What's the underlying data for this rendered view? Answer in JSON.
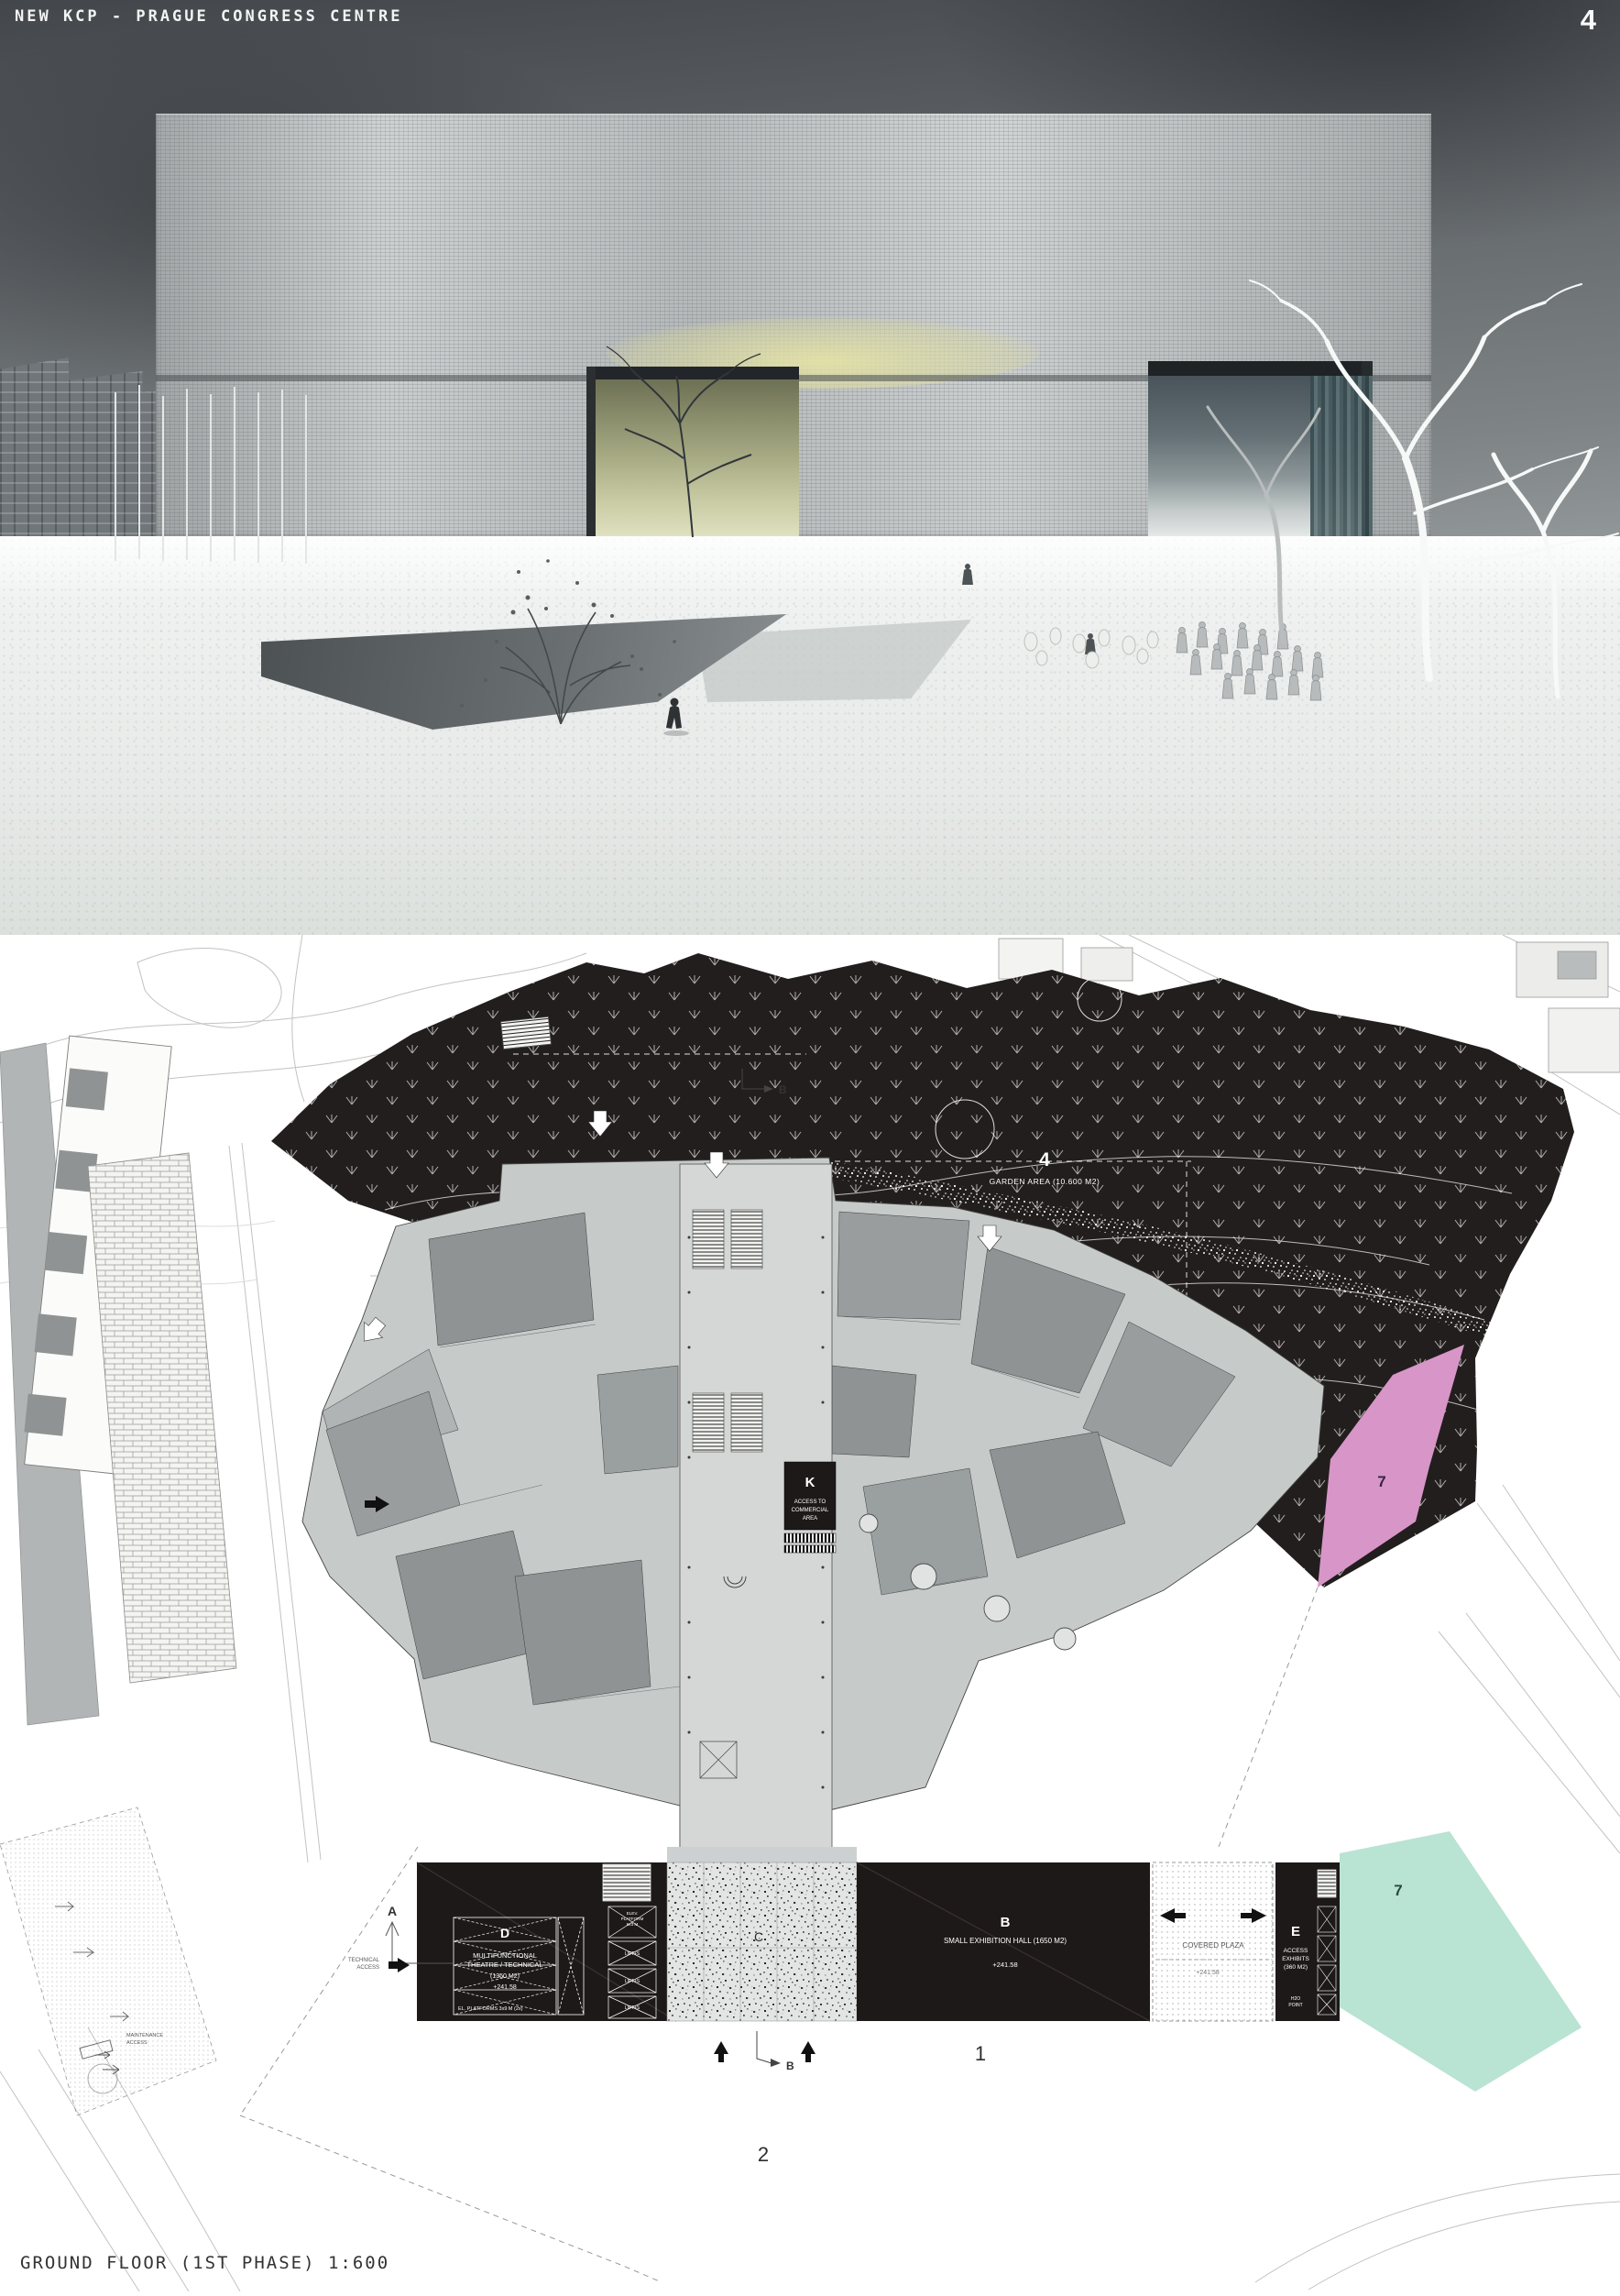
{
  "header": {
    "title": "NEW KCP - PRAGUE CONGRESS CENTRE",
    "page_number": "4"
  },
  "footer": {
    "caption": "GROUND FLOOR (1ST PHASE) 1:600"
  },
  "plan": {
    "garden_number": "4",
    "garden_label": "GARDEN AREA (10.600 M2)",
    "k_letter": "K",
    "k_line1": "ACCESS TO",
    "k_line2": "COMMERCIAL",
    "k_line3": "AREA",
    "d_letter": "D",
    "d_line1": "MULTIFUNCTIONAL",
    "d_line2": "THEATRE / TECHNICAL",
    "d_line3": "(1350 M2)",
    "d_level": "+241.58",
    "d_note": "EL. PLATFORMS 3x9 M (2x)",
    "elev_line1": "ELEV.",
    "elev_line2": "PLATFORM",
    "elev_line3": "6x3 M",
    "lift_1": "LIFT+S",
    "lift_2": "LIFT+S",
    "lift_3": "LIFT+S",
    "c_letter": "C",
    "b_letter": "B",
    "b_label": "SMALL EXHIBITION HALL (1650 M2)",
    "b_level": "+241.58",
    "plaza_label": "COVERED PLAZA",
    "plaza_level": "+241.58",
    "e_letter": "E",
    "e_line1": "ACCESS",
    "e_line2": "EXHIBITS",
    "e_line3": "(360 M2)",
    "h2o_line1": "H2O",
    "h2o_line2": "POINT",
    "zone7_pink": "7",
    "zone7_green": "7",
    "marker_a": "A",
    "marker_b_top": "B",
    "marker_b_bottom": "B",
    "area_1": "1",
    "area_2": "2",
    "tech_access_1": "TECHNICAL",
    "tech_access_2": "ACCESS",
    "maint_access_1": "MAINTENANCE",
    "maint_access_2": "ACCESS"
  },
  "colors": {
    "sky_top": "#45494d",
    "snow": "#eef0ee",
    "accent_yellow": "#d9d9a6",
    "garden_black": "#221e1e",
    "block_black": "#1d1918",
    "building_gray": "#c6cac9",
    "room_gray": "#949899",
    "pink_zone": "#d796c7",
    "green_zone": "#b9e3d3",
    "granite_bg": "#e2e5e3"
  }
}
